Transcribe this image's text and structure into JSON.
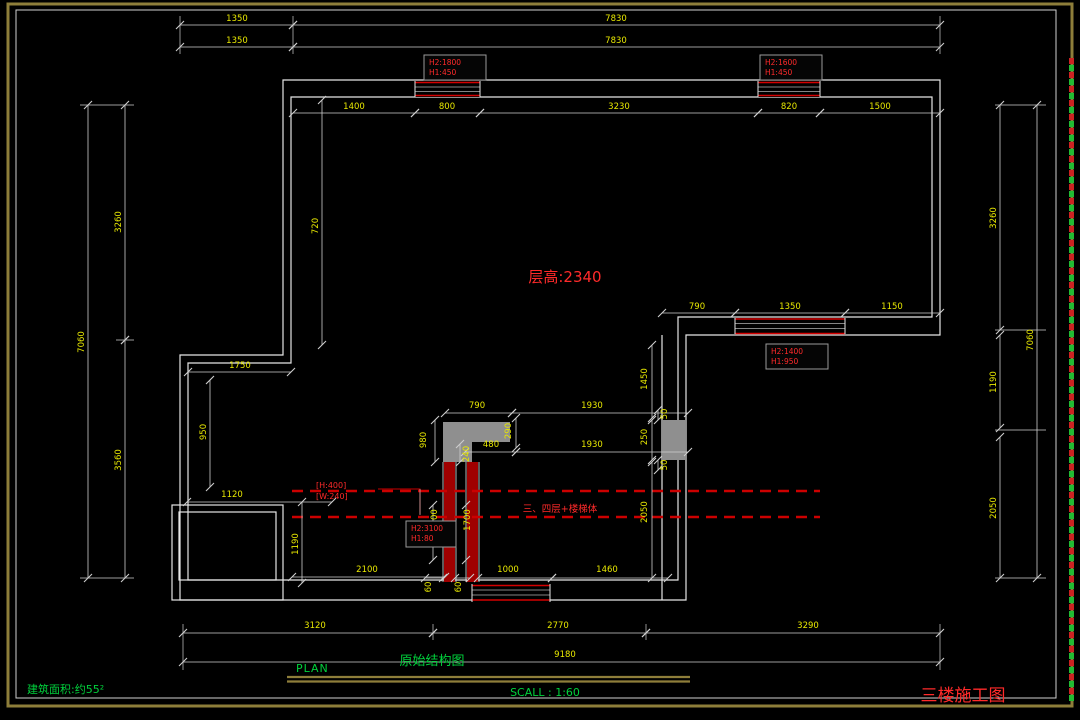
{
  "colors": {
    "background": "#000000",
    "wall_line": "#e6e6e6",
    "dim_line": "#cfcfcf",
    "dim_text": "#e8e800",
    "annotation_red": "#e60000",
    "green_text": "#00d23c",
    "border_tan": "#8e7e3a",
    "column_gray": "#8f8f8f",
    "window_red": "#d40000"
  },
  "labels": {
    "floor_height": "层高:2340",
    "demolish_note": "三、四层+楼梯体",
    "plan": "PLAN",
    "drawing_title": "原始结构图",
    "scale": "SCALL : 1:60",
    "area": "建筑面积:约55²",
    "sheet_title": "三楼施工图",
    "beam_note_line1": "[H:400]",
    "beam_note_line2": "[W:240]"
  },
  "window_specs": [
    {
      "x": 424,
      "y": 55,
      "w": 62,
      "h": 25,
      "line1": "H2:1800",
      "line2": "H1:450"
    },
    {
      "x": 760,
      "y": 55,
      "w": 62,
      "h": 25,
      "line1": "H2:1600",
      "line2": "H1:450"
    },
    {
      "x": 766,
      "y": 344,
      "w": 62,
      "h": 25,
      "line1": "H2:1400",
      "line2": "H1:950"
    },
    {
      "x": 406,
      "y": 521,
      "w": 50,
      "h": 26,
      "line1": "H2:3100",
      "line2": "H1:80"
    }
  ],
  "dimensions": [
    {
      "v": "1350",
      "l": [
        180,
        25,
        293,
        25
      ],
      "t": [
        237,
        21
      ]
    },
    {
      "v": "7830",
      "l": [
        293,
        25,
        940,
        25
      ],
      "t": [
        616,
        21
      ]
    },
    {
      "v": "1350",
      "l": [
        180,
        47,
        293,
        47
      ],
      "t": [
        237,
        43
      ]
    },
    {
      "v": "7830",
      "l": [
        293,
        47,
        940,
        47
      ],
      "t": [
        616,
        43
      ]
    },
    {
      "v": "1400",
      "l": [
        293,
        113,
        415,
        113
      ],
      "t": [
        354,
        109
      ]
    },
    {
      "v": "800",
      "l": [
        415,
        113,
        480,
        113
      ],
      "t": [
        447,
        109
      ]
    },
    {
      "v": "3230",
      "l": [
        480,
        113,
        758,
        113
      ],
      "t": [
        619,
        109
      ]
    },
    {
      "v": "820",
      "l": [
        758,
        113,
        820,
        113
      ],
      "t": [
        789,
        109
      ]
    },
    {
      "v": "1500",
      "l": [
        820,
        113,
        940,
        113
      ],
      "t": [
        880,
        109
      ]
    },
    {
      "v": "7060",
      "l": [
        88,
        105,
        88,
        578
      ],
      "t": [
        84,
        342
      ],
      "r": -90
    },
    {
      "v": "3260",
      "l": [
        125,
        105,
        125,
        340
      ],
      "t": [
        121,
        222
      ],
      "r": -90
    },
    {
      "v": "3560",
      "l": [
        125,
        340,
        125,
        578
      ],
      "t": [
        121,
        460
      ],
      "r": -90
    },
    {
      "v": "3260",
      "l": [
        1000,
        105,
        1000,
        330
      ],
      "t": [
        996,
        218
      ],
      "r": -90
    },
    {
      "v": "1190",
      "l": [
        1000,
        335,
        1000,
        428
      ],
      "t": [
        996,
        382
      ],
      "r": -90
    },
    {
      "v": "2050",
      "l": [
        1000,
        437,
        1000,
        578
      ],
      "t": [
        996,
        508
      ],
      "r": -90
    },
    {
      "v": "7060",
      "l": [
        1037,
        105,
        1037,
        578
      ],
      "t": [
        1033,
        340
      ],
      "r": -90
    },
    {
      "v": "3120",
      "l": [
        183,
        633,
        433,
        633
      ],
      "t": [
        315,
        628
      ]
    },
    {
      "v": "2770",
      "l": [
        433,
        633,
        646,
        633
      ],
      "t": [
        558,
        628
      ]
    },
    {
      "v": "3290",
      "l": [
        646,
        633,
        940,
        633
      ],
      "t": [
        808,
        628
      ]
    },
    {
      "v": "9180",
      "l": [
        183,
        662,
        940,
        662
      ],
      "t": [
        565,
        657
      ]
    },
    {
      "v": "720",
      "l": [
        322,
        100,
        322,
        345
      ],
      "t": [
        318,
        226
      ],
      "r": -90
    },
    {
      "v": "1750",
      "l": [
        188,
        372,
        291,
        372
      ],
      "t": [
        240,
        368
      ]
    },
    {
      "v": "950",
      "l": [
        210,
        380,
        210,
        487
      ],
      "t": [
        206,
        432
      ],
      "r": -90
    },
    {
      "v": "1120",
      "l": [
        187,
        502,
        332,
        502
      ],
      "t": [
        232,
        497
      ]
    },
    {
      "v": "1190",
      "l": [
        302,
        502,
        302,
        583
      ],
      "t": [
        298,
        544
      ],
      "r": -90
    },
    {
      "v": "2100",
      "l": [
        292,
        577,
        445,
        577
      ],
      "t": [
        367,
        572
      ]
    },
    {
      "v": "60",
      "l": [
        425,
        578,
        443,
        578
      ],
      "t": [
        431,
        587
      ],
      "r": -90
    },
    {
      "v": "60",
      "l": [
        455,
        578,
        470,
        578
      ],
      "t": [
        461,
        587
      ],
      "r": -90
    },
    {
      "v": "1000",
      "l": [
        478,
        578,
        552,
        578
      ],
      "t": [
        508,
        572
      ]
    },
    {
      "v": "1460",
      "l": [
        552,
        578,
        668,
        578
      ],
      "t": [
        607,
        572
      ]
    },
    {
      "v": "790",
      "l": [
        445,
        413,
        512,
        413
      ],
      "t": [
        477,
        408
      ]
    },
    {
      "v": "1930",
      "l": [
        512,
        413,
        688,
        413
      ],
      "t": [
        592,
        408
      ]
    },
    {
      "v": "290",
      "l": [
        516,
        418,
        516,
        448
      ],
      "t": [
        511,
        431
      ],
      "r": -90
    },
    {
      "v": "480",
      "l": [
        465,
        452,
        516,
        452
      ],
      "t": [
        491,
        447
      ]
    },
    {
      "v": "1930",
      "l": [
        516,
        452,
        688,
        452
      ],
      "t": [
        592,
        447
      ]
    },
    {
      "v": "240",
      "l": [
        460,
        444,
        460,
        462
      ],
      "t": [
        469,
        454
      ],
      "r": -90
    },
    {
      "v": "980",
      "l": [
        435,
        420,
        435,
        462
      ],
      "t": [
        426,
        440
      ],
      "r": -90
    },
    {
      "v": "1450",
      "l": [
        652,
        345,
        652,
        418
      ],
      "t": [
        647,
        379
      ],
      "r": -90
    },
    {
      "v": "50",
      "l": [
        658,
        410,
        658,
        420
      ],
      "t": [
        667,
        414
      ],
      "r": -90
    },
    {
      "v": "250",
      "l": [
        652,
        420,
        652,
        460
      ],
      "t": [
        647,
        437
      ],
      "r": -90
    },
    {
      "v": "50",
      "l": [
        658,
        460,
        658,
        470
      ],
      "t": [
        667,
        465
      ],
      "r": -90
    },
    {
      "v": "2050",
      "l": [
        652,
        462,
        652,
        578
      ],
      "t": [
        647,
        512
      ],
      "r": -90
    },
    {
      "v": "1700",
      "l": [
        433,
        505,
        433,
        560
      ],
      "t": [
        437,
        520
      ],
      "r": -90
    },
    {
      "v": "1700",
      "l": [
        466,
        505,
        466,
        560
      ],
      "t": [
        470,
        520
      ],
      "r": -90
    },
    {
      "v": "790",
      "l": [
        662,
        313,
        735,
        313
      ],
      "t": [
        697,
        309
      ]
    },
    {
      "v": "1350",
      "l": [
        735,
        313,
        845,
        313
      ],
      "t": [
        790,
        309
      ]
    },
    {
      "v": "1150",
      "l": [
        845,
        313,
        940,
        313
      ],
      "t": [
        892,
        309
      ]
    }
  ],
  "extension_lines": [
    [
      180,
      16,
      180,
      54
    ],
    [
      293,
      16,
      293,
      54
    ],
    [
      940,
      16,
      940,
      54
    ],
    [
      80,
      105,
      134,
      105
    ],
    [
      80,
      578,
      134,
      578
    ],
    [
      116,
      340,
      134,
      340
    ],
    [
      995,
      105,
      1046,
      105
    ],
    [
      995,
      330,
      1046,
      330
    ],
    [
      995,
      430,
      1046,
      430
    ],
    [
      995,
      578,
      1046,
      578
    ],
    [
      183,
      624,
      183,
      670
    ],
    [
      433,
      624,
      433,
      640
    ],
    [
      646,
      624,
      646,
      640
    ],
    [
      940,
      624,
      940,
      670
    ],
    [
      420,
      489,
      420,
      515
    ]
  ]
}
